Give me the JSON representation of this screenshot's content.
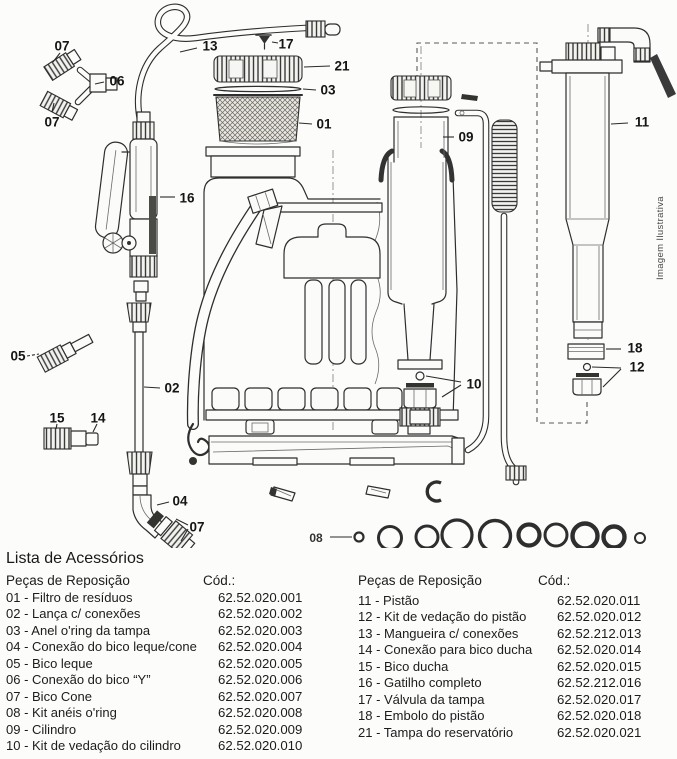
{
  "diagram": {
    "watermark": "Imagem Ilustrativa",
    "callouts": [
      {
        "label": "07"
      },
      {
        "label": "06"
      },
      {
        "label": "07"
      },
      {
        "label": "13"
      },
      {
        "label": "17"
      },
      {
        "label": "21"
      },
      {
        "label": "03"
      },
      {
        "label": "01"
      },
      {
        "label": "09"
      },
      {
        "label": "11"
      },
      {
        "label": "16"
      },
      {
        "label": "05"
      },
      {
        "label": "02"
      },
      {
        "label": "15"
      },
      {
        "label": "14"
      },
      {
        "label": "10"
      },
      {
        "label": "18"
      },
      {
        "label": "12"
      },
      {
        "label": "04"
      },
      {
        "label": "07"
      },
      {
        "label": "08"
      }
    ]
  },
  "parts_list": {
    "title": "Lista de Acessórios",
    "left": {
      "header_parts": "Peças de Reposição",
      "header_code": "Cód.:",
      "items": [
        {
          "label": "01 - Filtro de resíduos",
          "code": "62.52.020.001"
        },
        {
          "label": "02 - Lança c/ conexões",
          "code": "62.52.020.002"
        },
        {
          "label": "03 - Anel o'ring da tampa",
          "code": "62.52.020.003"
        },
        {
          "label": "04 - Conexão do bico leque/cone",
          "code": "62.52.020.004"
        },
        {
          "label": "05 - Bico leque",
          "code": "62.52.020.005"
        },
        {
          "label": "06 - Conexão do bico “Y”",
          "code": "62.52.020.006"
        },
        {
          "label": "07 - Bico Cone",
          "code": "62.52.020.007"
        },
        {
          "label": "08 - Kit anéis o'ring",
          "code": "62.52.020.008"
        },
        {
          "label": "09 - Cilindro",
          "code": "62.52.020.009"
        },
        {
          "label": "10 - Kit de vedação do cilindro",
          "code": "62.52.020.010"
        }
      ]
    },
    "right": {
      "header_parts": "Peças de Reposição",
      "header_code": "Cód.:",
      "items": [
        {
          "label": "11 - Pistão",
          "code": "62.52.020.011"
        },
        {
          "label": "12 - Kit de vedação do pistão",
          "code": "62.52.020.012"
        },
        {
          "label": "13 - Mangueira c/ conexões",
          "code": "62.52.212.013"
        },
        {
          "label": "14 - Conexão para bico ducha",
          "code": "62.52.020.014"
        },
        {
          "label": "15 - Bico ducha",
          "code": "62.52.020.015"
        },
        {
          "label": "16 - Gatilho completo",
          "code": "62.52.212.016"
        },
        {
          "label": "17 - Válvula da tampa",
          "code": "62.52.020.017"
        },
        {
          "label": "18 - Embolo do pistão",
          "code": "62.52.020.018"
        },
        {
          "label": "21 - Tampa do reservatório",
          "code": "62.52.020.021"
        }
      ]
    }
  }
}
